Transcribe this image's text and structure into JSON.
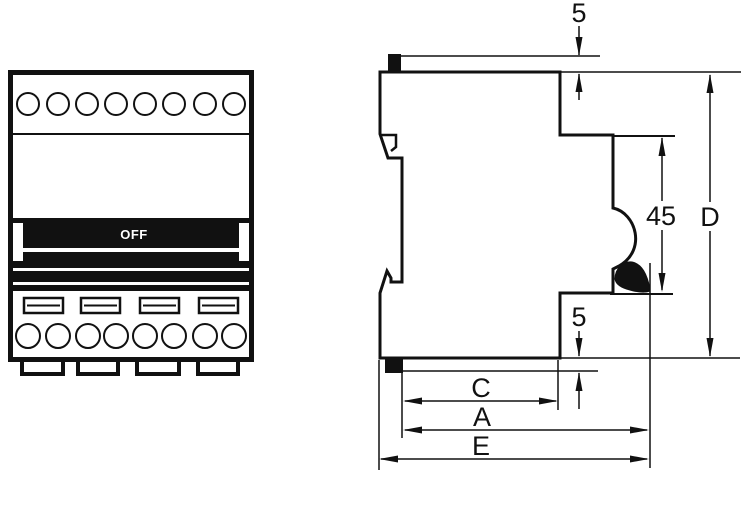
{
  "figure": {
    "description": "Dimension drawing of a 4-pole DIN-rail circuit breaker, front view and side view"
  },
  "front_view": {
    "toggle_label": "OFF",
    "top_terminal_count": 8,
    "bottom_terminal_count": 8,
    "screw_slot_count": 4,
    "feet_count": 4
  },
  "dimensions": {
    "top_clip_protrusion": {
      "label": "5"
    },
    "recess_height": {
      "label": "45"
    },
    "total_height": {
      "label": "D"
    },
    "bottom_clip_protrusion": {
      "label": "5"
    },
    "depth_c": {
      "label": "C"
    },
    "depth_a": {
      "label": "A"
    },
    "depth_e": {
      "label": "E"
    }
  },
  "colors": {
    "line": "#111111",
    "fill_black": "#111111",
    "background": "#ffffff",
    "toggle_text": "#ffffff"
  }
}
